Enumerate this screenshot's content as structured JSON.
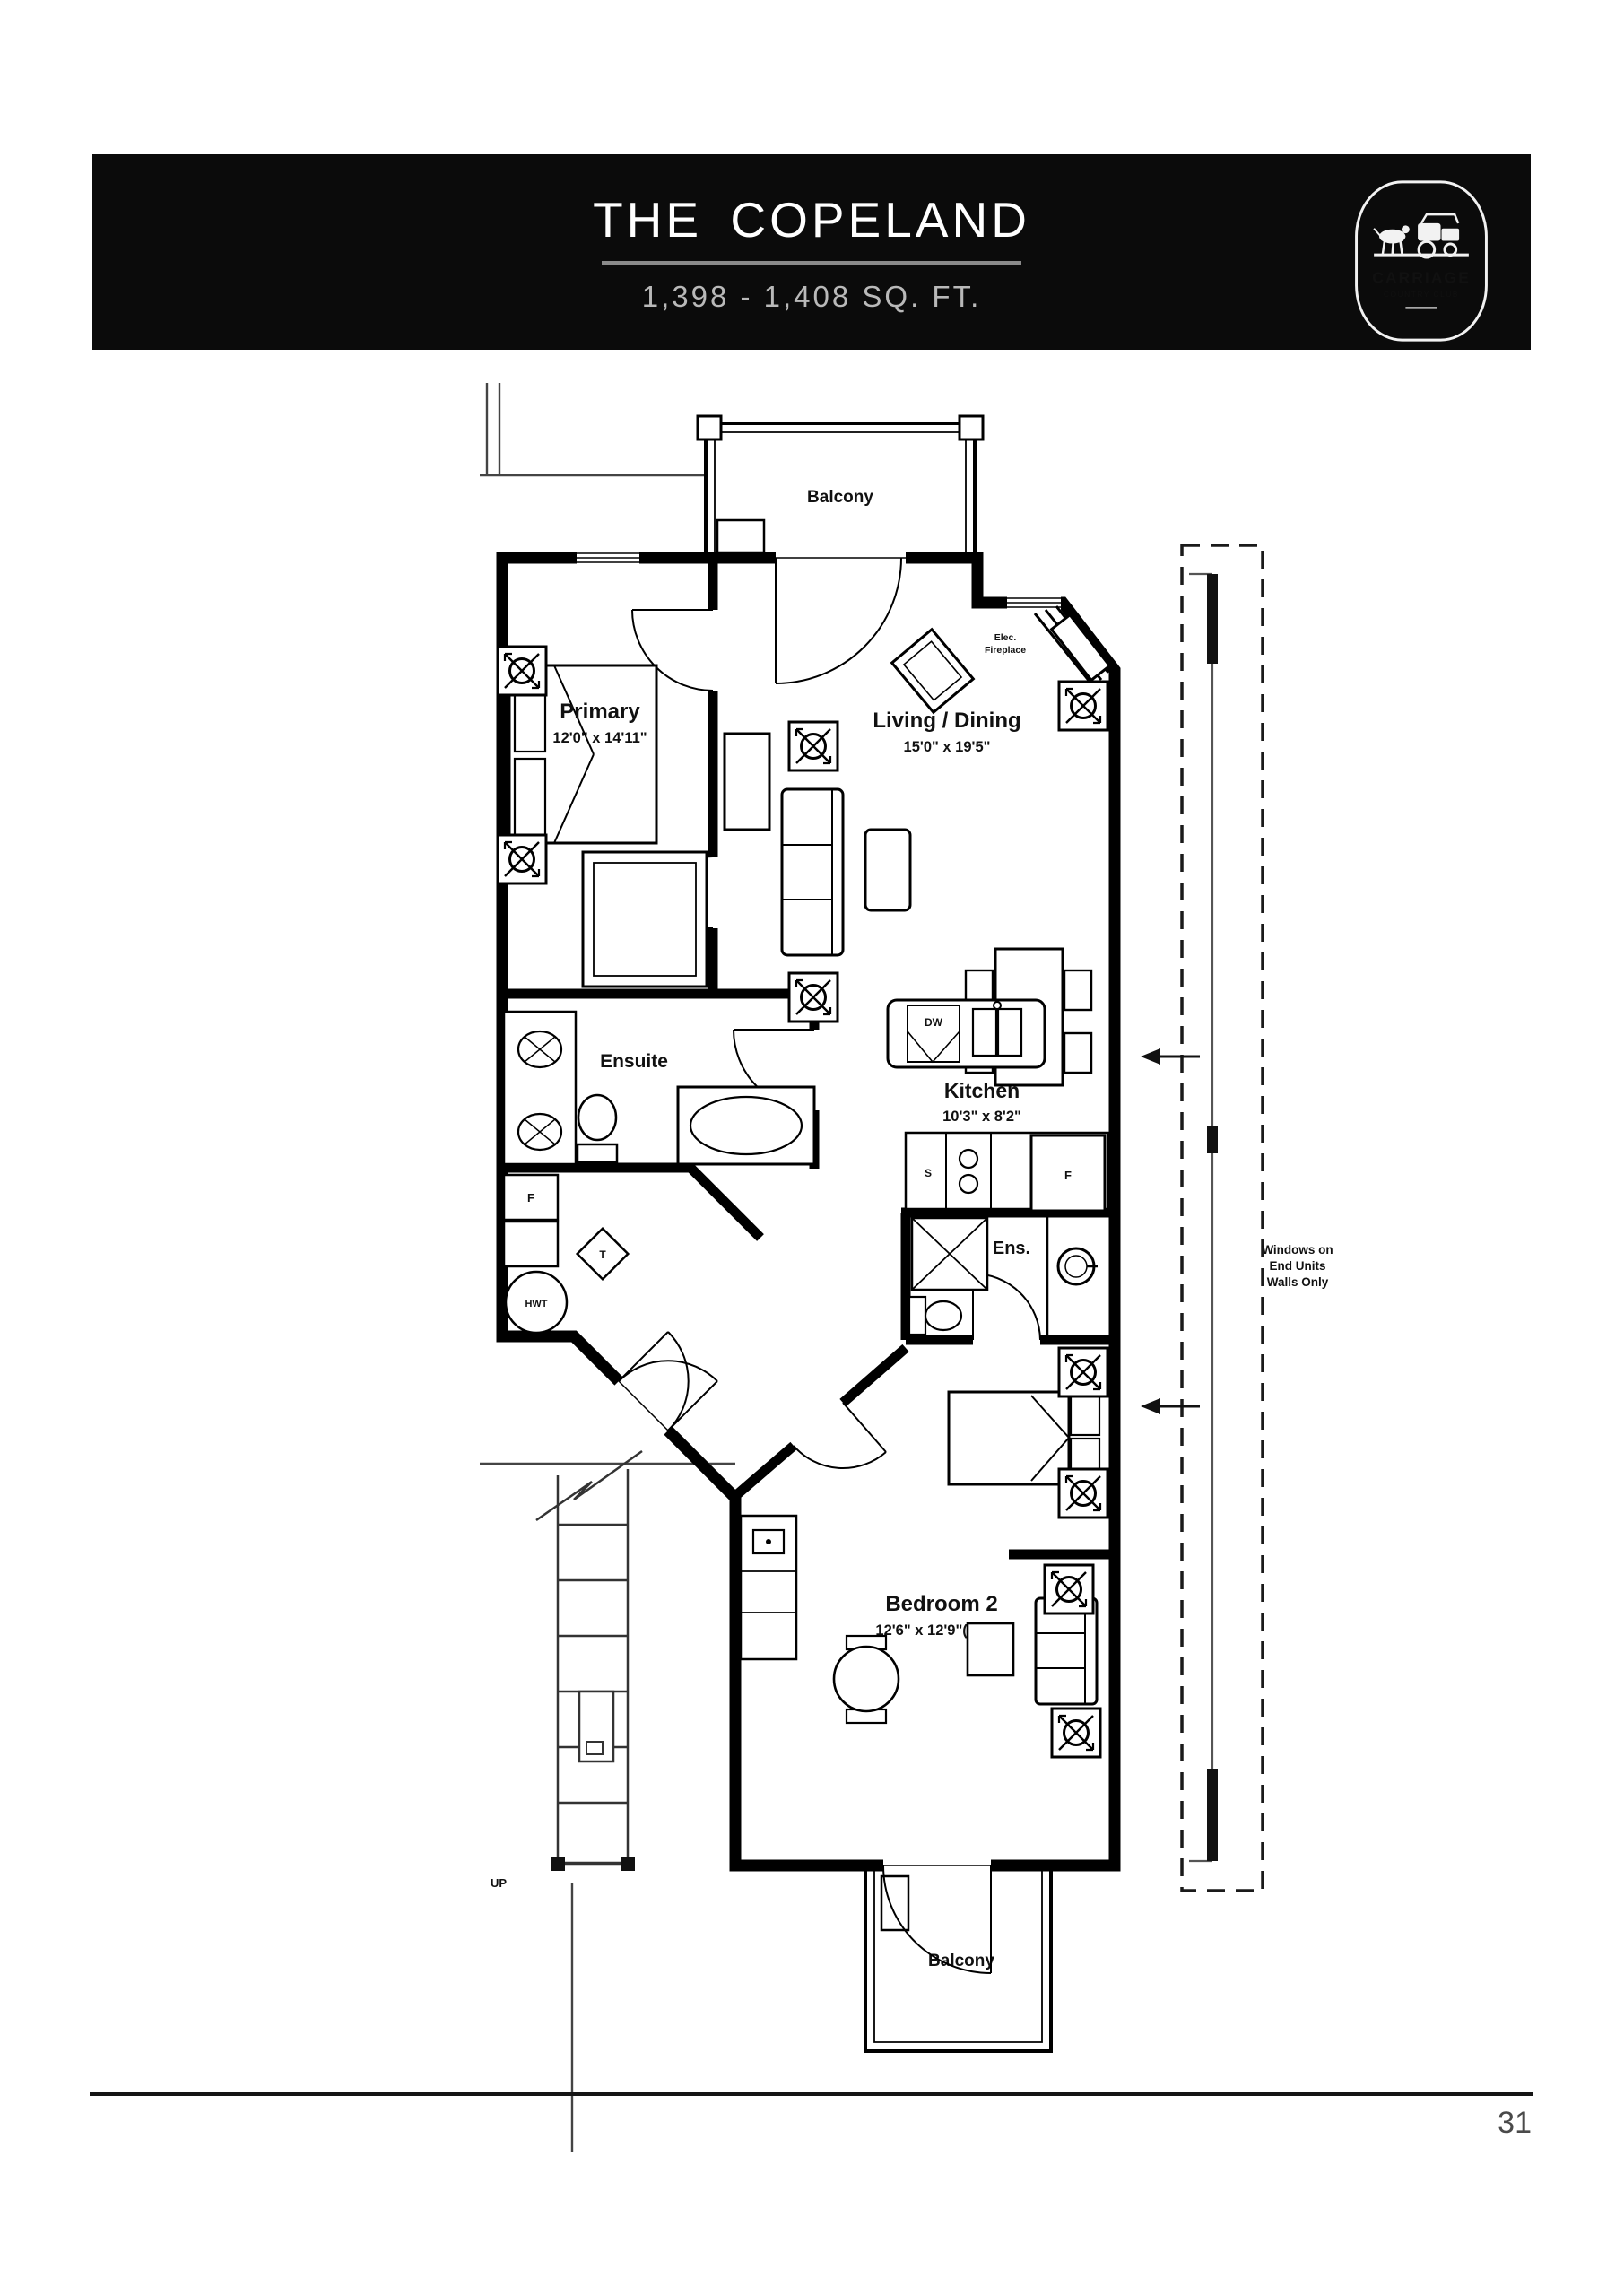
{
  "header": {
    "title": "THE COPELAND",
    "sqft": "1,398 - 1,408 SQ. FT.",
    "logo": {
      "line1": "CARRIAGE",
      "line2": "COUNTRY CLUB"
    }
  },
  "plan": {
    "balcony_top_label": "Balcony",
    "balcony_bottom_label": "Balcony",
    "primary_name": "Primary",
    "primary_dims": "12'0\" x 14'11\"",
    "living_name": "Living / Dining",
    "living_dims": "15'0\" x 19'5\"",
    "fireplace_line1": "Elec.",
    "fireplace_line2": "Fireplace",
    "ensuite_label": "Ensuite",
    "kitchen_name": "Kitchen",
    "kitchen_dims": "10'3\" x 8'2\"",
    "ens2_label": "Ens.",
    "bedroom2_name": "Bedroom 2",
    "bedroom2_dims": "12'6\" x 12'9\"(24'0\")",
    "dishwasher_label": "DW",
    "stove_label": "S",
    "fridge_label": "F",
    "furnace_label": "F",
    "hot_water_tank_label": "HWT",
    "thermostat_label": "T",
    "stairs_up_label": "UP",
    "note_line1": "Windows on",
    "note_line2": "End Units",
    "note_line3": "Walls Only"
  },
  "footer": {
    "page_number": "31"
  },
  "colors": {
    "header_bg": "#0b0b0b",
    "title_underline": "#8a8a8a",
    "subtitle_gray": "#b9b9b9",
    "walls": "#000000"
  }
}
